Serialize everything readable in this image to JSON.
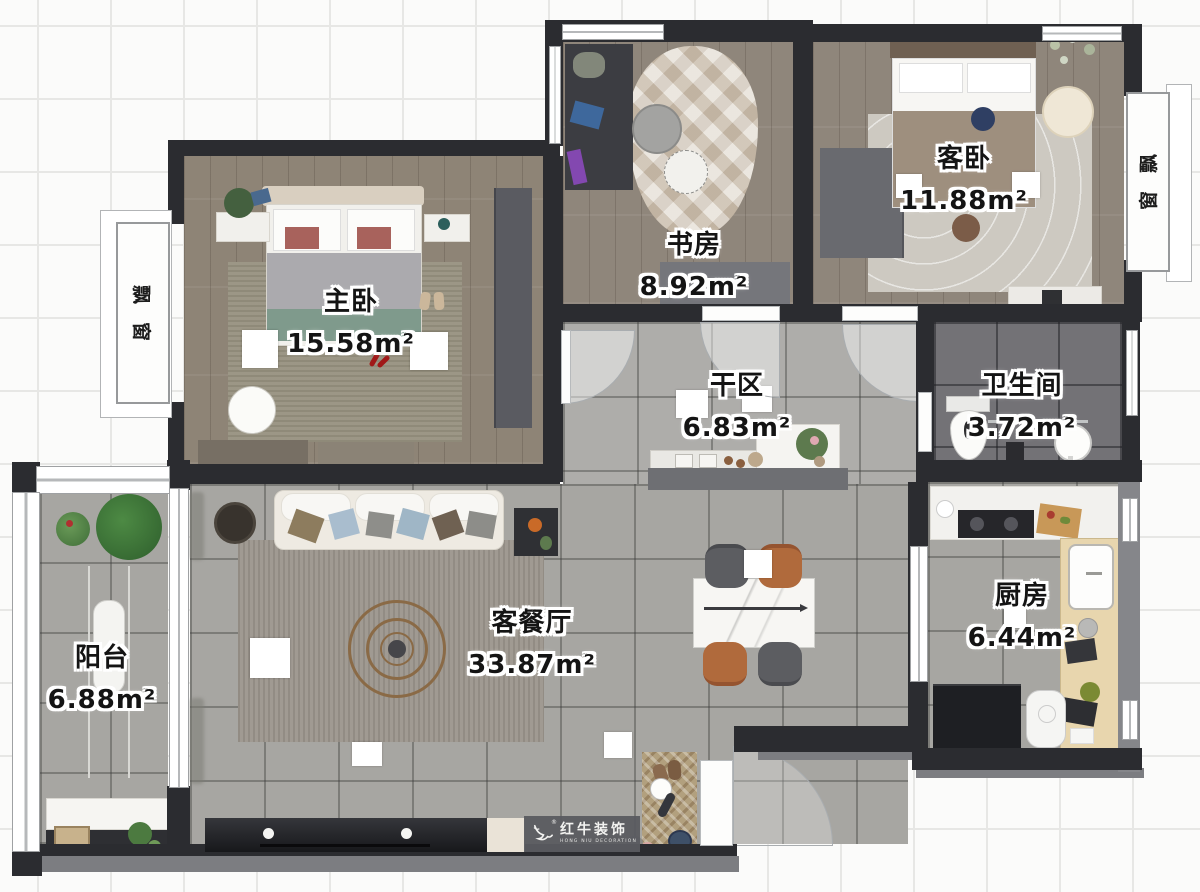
{
  "plan": {
    "brand": {
      "name_cn": "红牛装饰",
      "name_en": "HONG NIU DECORATION",
      "registered_mark": "®"
    },
    "rooms": {
      "master": {
        "name": "主卧",
        "area": "15.58m²"
      },
      "study": {
        "name": "书房",
        "area": "8.92m²"
      },
      "guest": {
        "name": "客卧",
        "area": "11.88m²"
      },
      "dry_area": {
        "name": "干区",
        "area": "6.83m²"
      },
      "bathroom": {
        "name": "卫生间",
        "area": "3.72m²"
      },
      "kitchen": {
        "name": "厨房",
        "area": "6.44m²"
      },
      "living_dining": {
        "name": "客餐厅",
        "area": "33.87m²"
      },
      "balcony": {
        "name": "阳台",
        "area": "6.88m²"
      },
      "bay_left": {
        "name": "飘窗",
        "char1": "飘",
        "char2": "窗"
      },
      "bay_right": {
        "name": "飘窗",
        "char1": "飘",
        "char2": "窗"
      }
    }
  }
}
